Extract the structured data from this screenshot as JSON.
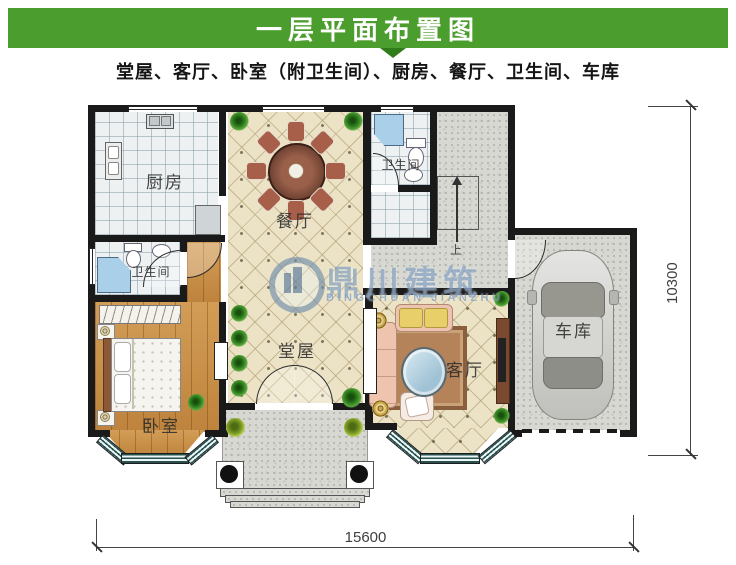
{
  "header": {
    "title": "一层平面布置图",
    "subtitle": "堂屋、客厅、卧室（附卫生间）、厨房、餐厅、卫生间、车库"
  },
  "rooms": {
    "kitchen": "厨房",
    "dining": "餐厅",
    "bath_top": "卫生间",
    "bath_ensuite": "卫生间",
    "bedroom": "卧室",
    "hall": "堂屋",
    "living": "客厅",
    "garage": "车库",
    "stairs_up": "上"
  },
  "dimensions": {
    "bottom_width": "15600",
    "right_height": "10300"
  },
  "watermark": {
    "cn": "鼎川建筑",
    "en": "DINGCHUAN JIANZHU"
  },
  "colors": {
    "header_green": "#4b9e2d",
    "wall": "#1a1a1a",
    "tile_cream": "#ece3c6",
    "wood": "#c98e44",
    "concrete": "#d8d8d3",
    "shower_blue": "#a9d0e8"
  }
}
